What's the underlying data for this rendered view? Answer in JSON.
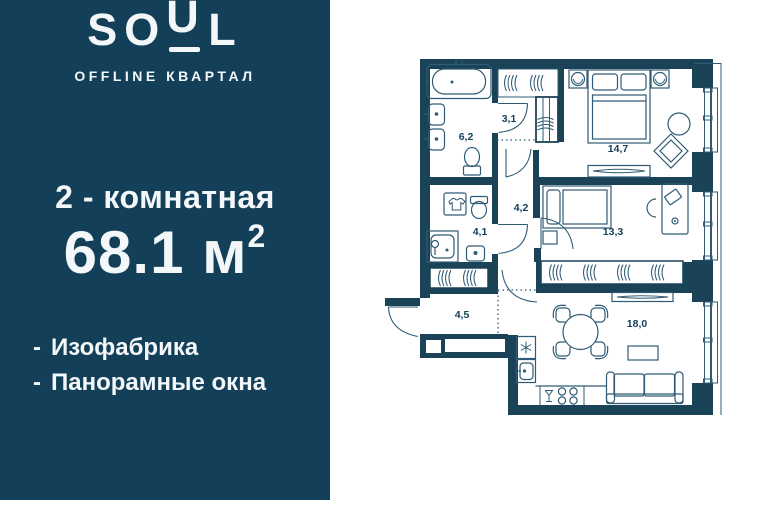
{
  "brand": {
    "logo_part1": "SO",
    "logo_part2": "U",
    "logo_part3": "L",
    "subtitle": "OFFLINE КВАРТАЛ"
  },
  "offer": {
    "unit_type": "2 - комнатная",
    "area_value": "68.1",
    "area_unit": "м",
    "area_superscript": "2",
    "bullet": "-",
    "features": [
      {
        "label": "Изофабрика"
      },
      {
        "label": "Панорамные окна"
      }
    ]
  },
  "colors": {
    "panel_bg": "#134058",
    "wall": "#1B4358",
    "plan_line": "#2F5B76",
    "room_label": "#16405A",
    "text": "#F3F7F9"
  },
  "plan": {
    "rooms": [
      {
        "name": "bathroom",
        "area": "6,2"
      },
      {
        "name": "closet-hall",
        "area": "3,1"
      },
      {
        "name": "bedroom",
        "area": "14,7"
      },
      {
        "name": "hallway",
        "area": "4,2"
      },
      {
        "name": "bathroom-2",
        "area": "4,1"
      },
      {
        "name": "bedroom-2",
        "area": "13,3"
      },
      {
        "name": "entry-hall",
        "area": "4,5"
      },
      {
        "name": "kitchen-living",
        "area": "18,0"
      }
    ]
  }
}
